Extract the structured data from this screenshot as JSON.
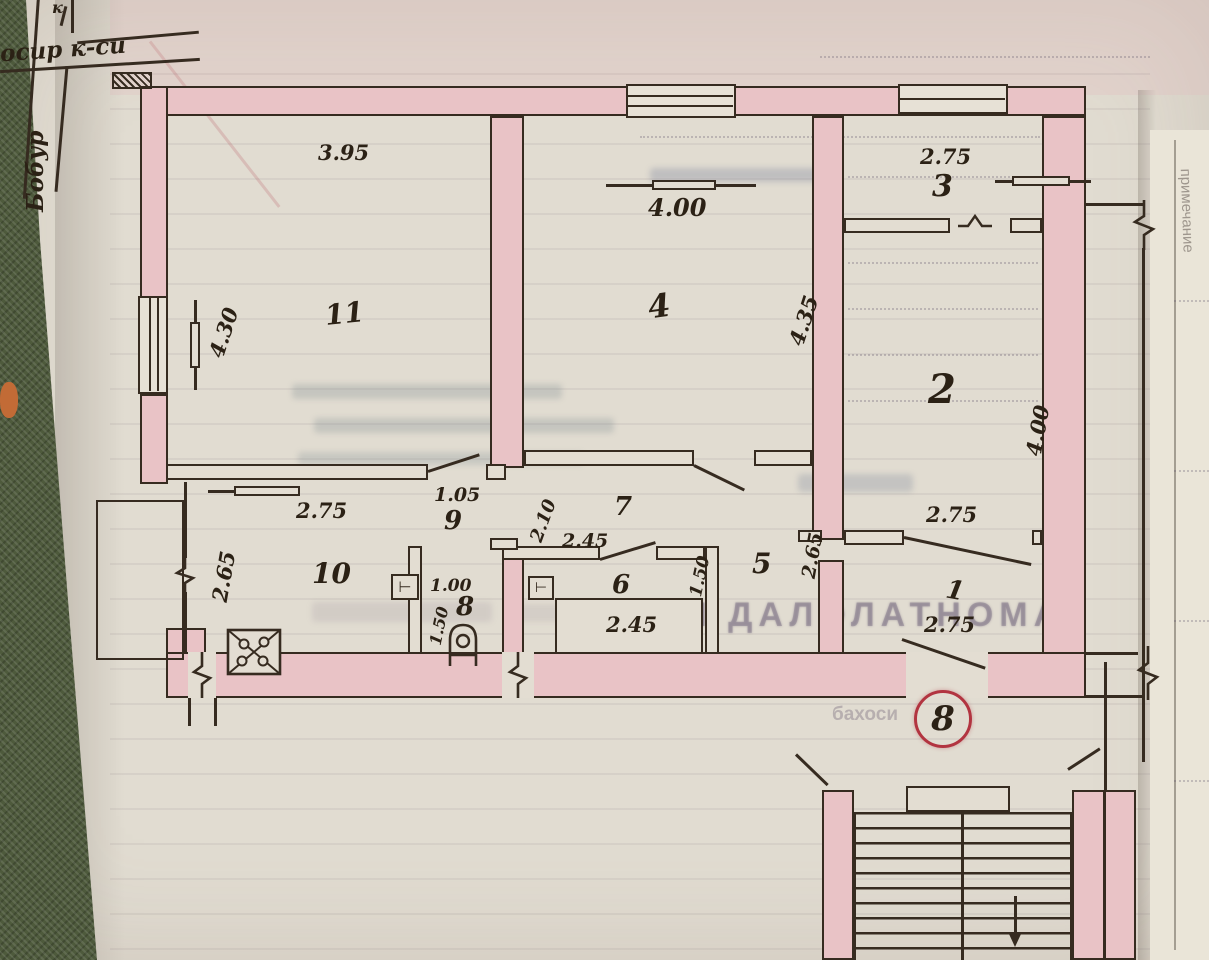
{
  "street_map": {
    "street_horizontal": "осир к-си",
    "street_vertical": "Бобур",
    "north_label": "к"
  },
  "rooms": {
    "r1": "1",
    "r2": "2",
    "r3": "3",
    "r4": "4",
    "r5": "5",
    "r6": "6",
    "r7": "7",
    "r8": "8",
    "r9": "9",
    "r10": "10",
    "r11": "11"
  },
  "dimensions": {
    "room11_top": "3.95",
    "room11_left": "4.30",
    "room4_top": "4.00",
    "room4_right": "4.35",
    "room3_top": "2.75",
    "room2_right": "4.00",
    "room2_door": "2.75",
    "room1_door": "2.75",
    "room10_top": "2.75",
    "room10_left": "2.65",
    "hall9_door": "1.05",
    "corridor7_width": "2.10",
    "corridor7_door": "2.45",
    "bathtub": "2.45",
    "bath6_right": "1.50",
    "wc8_top": "1.00",
    "wc8_left": "1.50",
    "hall5_width": "2.65"
  },
  "stamp_number": "8",
  "underlying_form": {
    "heading_fragment": "АШ ДАЛОЛАТНОМА",
    "table_label_1": "Тиклаш",
    "table_label_2": "бахоси",
    "side_vertical_label": "примечание"
  },
  "colors": {
    "wall_highlight": "#e9c3c6",
    "ink": "#362b20",
    "stamp_red": "#b23440",
    "paper": "#e1dcd1",
    "fabric_green": "#4e5a3c"
  }
}
